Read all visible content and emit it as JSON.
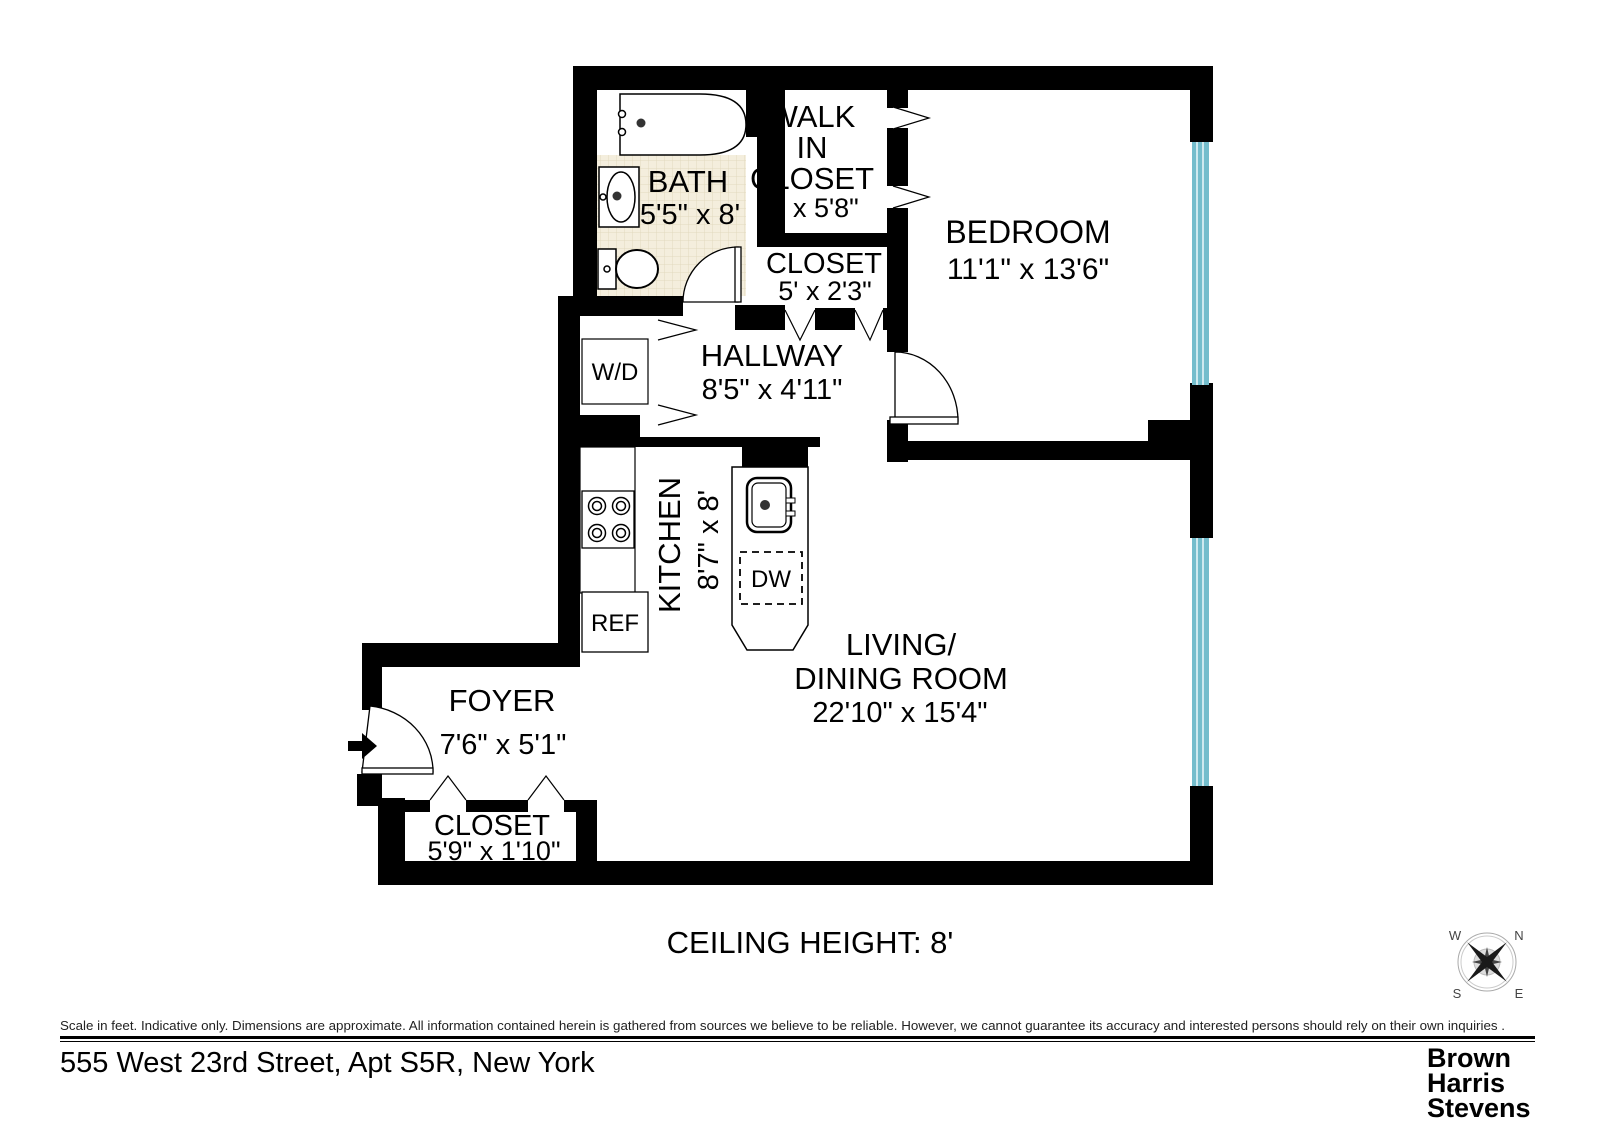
{
  "floorplan": {
    "rooms": {
      "bath": {
        "name": "BATH",
        "dims": "5'5\" x 8'"
      },
      "walk_in_closet": {
        "line1": "WALK",
        "line2": "IN",
        "line3": "CLOSET",
        "dims": "5' x 5'8\""
      },
      "bedroom": {
        "name": "BEDROOM",
        "dims": "11'1\" x 13'6\""
      },
      "hall_closet": {
        "name": "CLOSET",
        "dims": "5' x 2'3\""
      },
      "hallway": {
        "name": "HALLWAY",
        "dims": "8'5\" x 4'11\""
      },
      "kitchen": {
        "name": "KITCHEN",
        "dims": "8'7\" x 8'"
      },
      "living_dining": {
        "line1": "LIVING/",
        "line2": "DINING ROOM",
        "dims": "22'10\" x 15'4\""
      },
      "foyer": {
        "name": "FOYER",
        "dims": "7'6\" x 5'1\""
      },
      "foyer_closet": {
        "name": "CLOSET",
        "dims": "5'9\" x 1'10\""
      }
    },
    "fixtures": {
      "washer_dryer": "W/D",
      "refrigerator": "REF",
      "dishwasher": "DW"
    },
    "ceiling_note": "CEILING HEIGHT: 8'",
    "compass": {
      "n": "N",
      "s": "S",
      "e": "E",
      "w": "W"
    },
    "colors": {
      "wall": "#000000",
      "window": "#74bdcc",
      "window_stripe": "#cfe9ef",
      "tile": "#f4eedd",
      "tile_grid": "#e2d9be",
      "logo": "#4d4d4d"
    }
  },
  "footer": {
    "disclaimer": "Scale in feet. Indicative only. Dimensions are approximate. All information contained herein is gathered from sources we believe to be reliable. However, we cannot guarantee its accuracy and interested persons should rely on their own inquiries .",
    "address": "555 West 23rd Street, Apt S5R, New York",
    "logo": {
      "line1": "Brown",
      "line2": "Harris",
      "line3": "Stevens"
    }
  }
}
